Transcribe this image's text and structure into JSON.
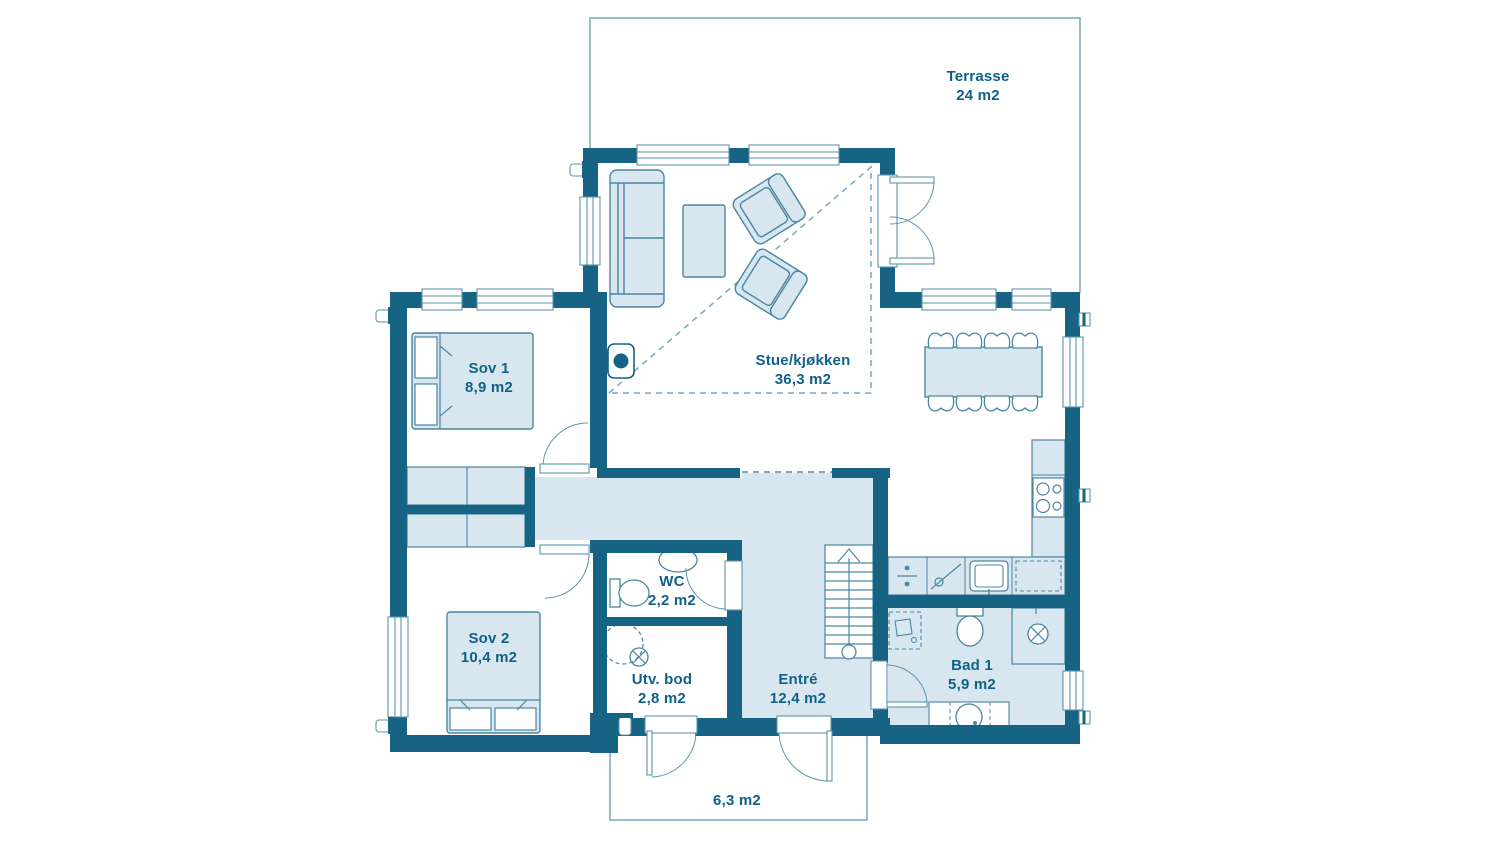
{
  "plan": {
    "title": "Floor plan",
    "rooms": [
      {
        "id": "terrasse",
        "name": "Terrasse",
        "area": "24 m2"
      },
      {
        "id": "stue-kjokken",
        "name": "Stue/kjøkken",
        "area": "36,3 m2"
      },
      {
        "id": "sov1",
        "name": "Sov 1",
        "area": "8,9 m2"
      },
      {
        "id": "sov2",
        "name": "Sov 2",
        "area": "10,4 m2"
      },
      {
        "id": "wc",
        "name": "WC",
        "area": "2,2 m2"
      },
      {
        "id": "utv-bod",
        "name": "Utv. bod",
        "area": "2,8 m2"
      },
      {
        "id": "entre",
        "name": "Entré",
        "area": "12,4 m2"
      },
      {
        "id": "bad1",
        "name": "Bad 1",
        "area": "5,9 m2"
      },
      {
        "id": "inngangsparti",
        "name": "",
        "area": "6,3 m2"
      }
    ],
    "colors": {
      "wall": "#176383",
      "light_fill": "#d8e6ef",
      "outline": "#4a86a4",
      "thin_line": "#7aa6bf",
      "label_text": "#0f618a"
    }
  }
}
